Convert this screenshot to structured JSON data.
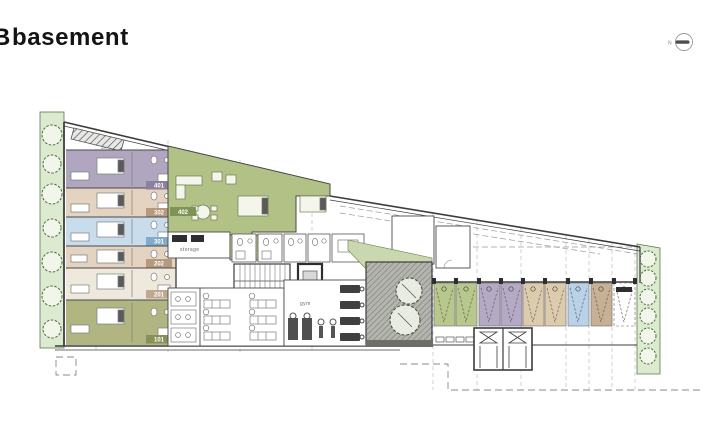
{
  "header": {
    "title_prefix": "B",
    "title": "basement"
  },
  "north": {
    "label": "N"
  },
  "colors": {
    "landscape_green": "#dcead0",
    "tree_green": "#5d7a4d",
    "terrace_gray": "#a3a39e",
    "apartment_green": "#b2c287",
    "pantry_green": "#bcc993",
    "wedge_green": "#c9d8ae",
    "wall": "#3c3c3c",
    "line_light": "#8a8a8a"
  },
  "plan": {
    "rooms": [
      {
        "number": "401",
        "fill": "#b1a6c0",
        "badge": "#8d7f9e"
      },
      {
        "number": "302",
        "fill": "#e3d3c0",
        "badge": "#b59a7e"
      },
      {
        "number": "301",
        "fill": "#c9dcec",
        "badge": "#82aacb"
      },
      {
        "number": "202",
        "fill": "#e3d3c0",
        "badge": "#b59a7e"
      },
      {
        "number": "201",
        "fill": "#efe9dd",
        "badge": "#bfa88d"
      },
      {
        "number": "101",
        "fill": "#b0b582",
        "badge": "#8a9158"
      }
    ],
    "apartment": {
      "number": "402",
      "fill": "#b2c287",
      "badge": "#7f9454"
    },
    "labels": {
      "storage": "storage",
      "gym": "gym"
    }
  },
  "parking": {
    "stalls": [
      {
        "color": "#b8c78b"
      },
      {
        "color": "#b8c78b"
      },
      {
        "color": "#b5aac6"
      },
      {
        "color": "#b5aac6"
      },
      {
        "color": "#ddcbae"
      },
      {
        "color": "#ddcbae"
      },
      {
        "color": "#b9d2e8"
      },
      {
        "color": "#c8b094"
      },
      {
        "color": "#ffffff"
      }
    ]
  }
}
